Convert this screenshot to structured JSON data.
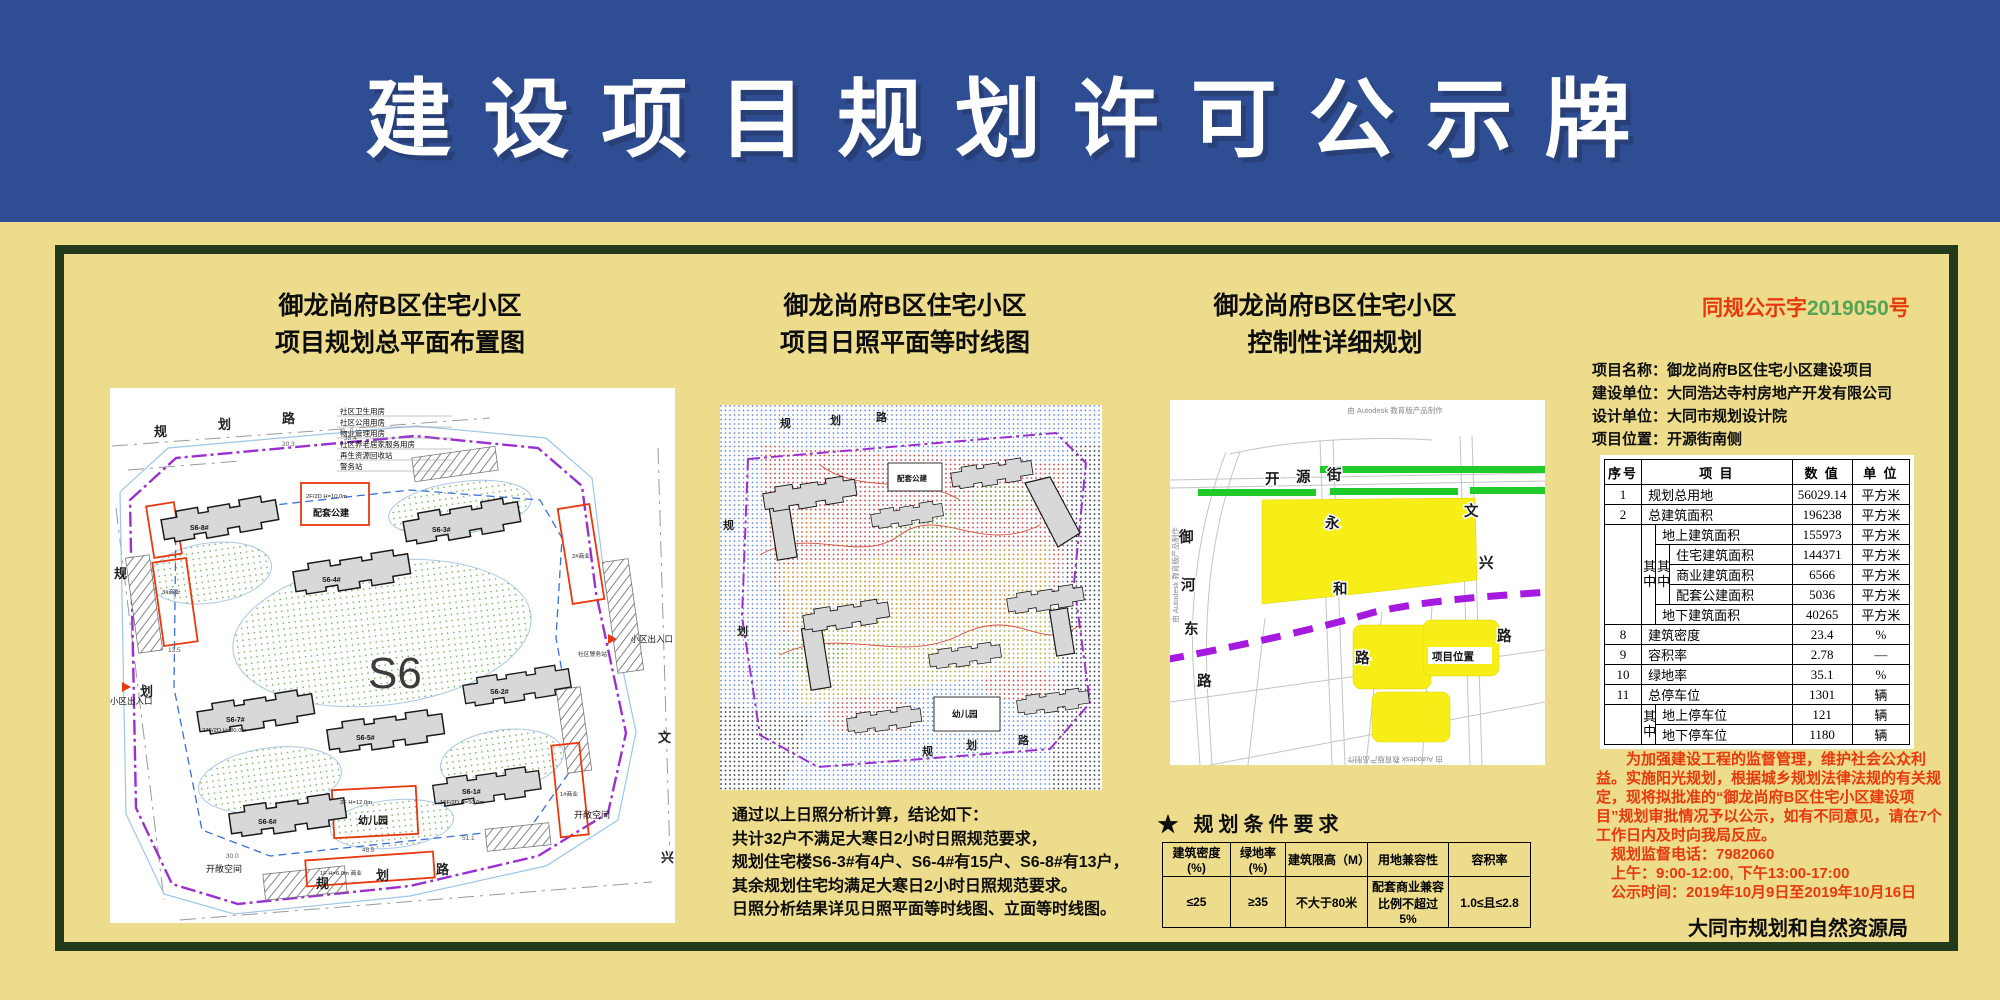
{
  "colors": {
    "header_blue": "#2e4d92",
    "board_yellow": "#ecdc8c",
    "frame_green": "#233b1c",
    "notice_red": "#e8380d",
    "doc_number_green": "#55a455",
    "parcel_yellow": "#f6ee16",
    "greenbelt_green": "#1ecb28",
    "boundary_purple": "#9b30d0"
  },
  "header": {
    "title": "建 设 项 目 规 划 许 可 公 示 牌"
  },
  "panels": {
    "p1": {
      "title1": "御龙尚府B区住宅小区",
      "title2": "项目规划总平面布置图",
      "plan": {
        "site_code": "S6",
        "roads": {
          "top": [
            "规",
            "划",
            "路"
          ],
          "bottom": [
            "规",
            "划",
            "路"
          ],
          "left": [
            "规",
            "划"
          ],
          "right": [
            "文",
            "兴"
          ]
        },
        "facilities": [
          "社区卫生用房",
          "社区公用用房",
          "物业管理用房",
          "社区养老居家服务用房",
          "再生资源回收站",
          "警务站"
        ],
        "buildings": [
          "S6-8#",
          "S6-3#",
          "S6-4#",
          "S6-7#",
          "S6-2#",
          "S6-5#",
          "S6-6#",
          "S6-1#"
        ],
        "annotations": {
          "b7": "27F/2D H=80.0m",
          "b1s": "16F/2D H=50.0m",
          "public": "2F/2D H=10.0m",
          "public_name": "配套公建",
          "kg": "3F H=12.0m",
          "kg_name": "幼儿园",
          "shop_left": "3#商业",
          "shop_right": "2#商业",
          "shop_right2": "1#商业",
          "shop_bottom": "1F H=6.0m 商业",
          "police": "社区警务站"
        },
        "open_space": "开敞空间",
        "entrance": "小区出入口",
        "dims": [
          "20.3",
          "35.4",
          "13.5",
          "48.6",
          "51.1",
          "30.0"
        ]
      }
    },
    "p2": {
      "title1": "御龙尚府B区住宅小区",
      "title2": "项目日照平面等时线图",
      "roads": {
        "top": [
          "规",
          "划",
          "路"
        ],
        "bottom": [
          "规",
          "划",
          "路"
        ],
        "left": [
          "规",
          "划"
        ]
      },
      "boxes": {
        "public": "配套公建",
        "kg": "幼儿园"
      },
      "conclusion": [
        "通过以上日照分析计算，结论如下：",
        "共计32户不满足大寒日2小时日照规范要求，",
        "规划住宅楼S6-3#有4户、S6-4#有15户、S6-8#有13户，",
        "其余规划住宅均满足大寒日2小时日照规范要求。",
        "日照分析结果详见日照平面等时线图、立面等时线图。"
      ]
    },
    "p3": {
      "title1": "御龙尚府B区住宅小区",
      "title2": "控制性详细规划",
      "map": {
        "credit": "由 Autodesk 教育版产品制作",
        "streets": {
          "kaiyuan": [
            "开",
            "源",
            "街"
          ],
          "yonghe": [
            "永",
            "和",
            "路"
          ],
          "wenxing": [
            "文",
            "兴",
            "路"
          ],
          "yuhedong": [
            "御",
            "河",
            "东",
            "路"
          ]
        },
        "project_location": "项目位置"
      },
      "conditions": {
        "heading": "★ 规划条件要求",
        "headers": [
          "建筑密度(%)",
          "绿地率(%)",
          "建筑限高（M）",
          "用地兼容性",
          "容积率"
        ],
        "values": [
          "≤25",
          "≥35",
          "不大于80米",
          "配套商业兼容比例不超过5%",
          "1.0≤且≤2.8"
        ]
      }
    },
    "p4": {
      "doc_no": {
        "prefix": "同规公示字",
        "number": "2019050",
        "suffix": "号"
      },
      "info": [
        "项目名称：御龙尚府B区住宅小区建设项目",
        "建设单位：大同浩达寺村房地产开发有限公司",
        "设计单位：大同市规划设计院",
        "项目位置：开源街南侧"
      ],
      "table": {
        "headers": [
          "序号",
          "项    目",
          "数  值",
          "单  位"
        ],
        "g1": "其中",
        "g2": "其中",
        "g3": "其中",
        "r1": {
          "no": "1",
          "item": "规划总用地",
          "value": "56029.14",
          "unit": "平方米"
        },
        "r2": {
          "no": "2",
          "item": "总建筑面积",
          "value": "196238",
          "unit": "平方米"
        },
        "r3": {
          "item": "地上建筑面积",
          "value": "155973",
          "unit": "平方米"
        },
        "r4": {
          "item": "住宅建筑面积",
          "value": "144371",
          "unit": "平方米"
        },
        "r5": {
          "item": "商业建筑面积",
          "value": "6566",
          "unit": "平方米"
        },
        "r6": {
          "item": "配套公建面积",
          "value": "5036",
          "unit": "平方米"
        },
        "r7": {
          "item": "地下建筑面积",
          "value": "40265",
          "unit": "平方米"
        },
        "r8": {
          "no": "8",
          "item": "建筑密度",
          "value": "23.4",
          "unit": "%"
        },
        "r9": {
          "no": "9",
          "item": "容积率",
          "value": "2.78",
          "unit": "—"
        },
        "r10": {
          "no": "10",
          "item": "绿地率",
          "value": "35.1",
          "unit": "%"
        },
        "r11": {
          "no": "11",
          "item": "总停车位",
          "value": "1301",
          "unit": "辆"
        },
        "r12": {
          "item": "地上停车位",
          "value": "121",
          "unit": "辆"
        },
        "r13": {
          "item": "地下停车位",
          "value": "1180",
          "unit": "辆"
        }
      },
      "notice": {
        "para": "为加强建设工程的监督管理，维护社会公众利益。实施阳光规划，根据城乡规划法律法规的有关规定，现将拟批准的“御龙尚府B区住宅小区建设项目”规划审批情况予以公示，如有不同意见，请在7个工作日内及时向我局反应。",
        "phone": "规划监督电话：7982060",
        "hours": "上午：9:00-12:00, 下午13:00-17:00",
        "period": "公示时间：2019年10月9日至2019年10月16日"
      },
      "footer": "大同市规划和自然资源局"
    }
  }
}
